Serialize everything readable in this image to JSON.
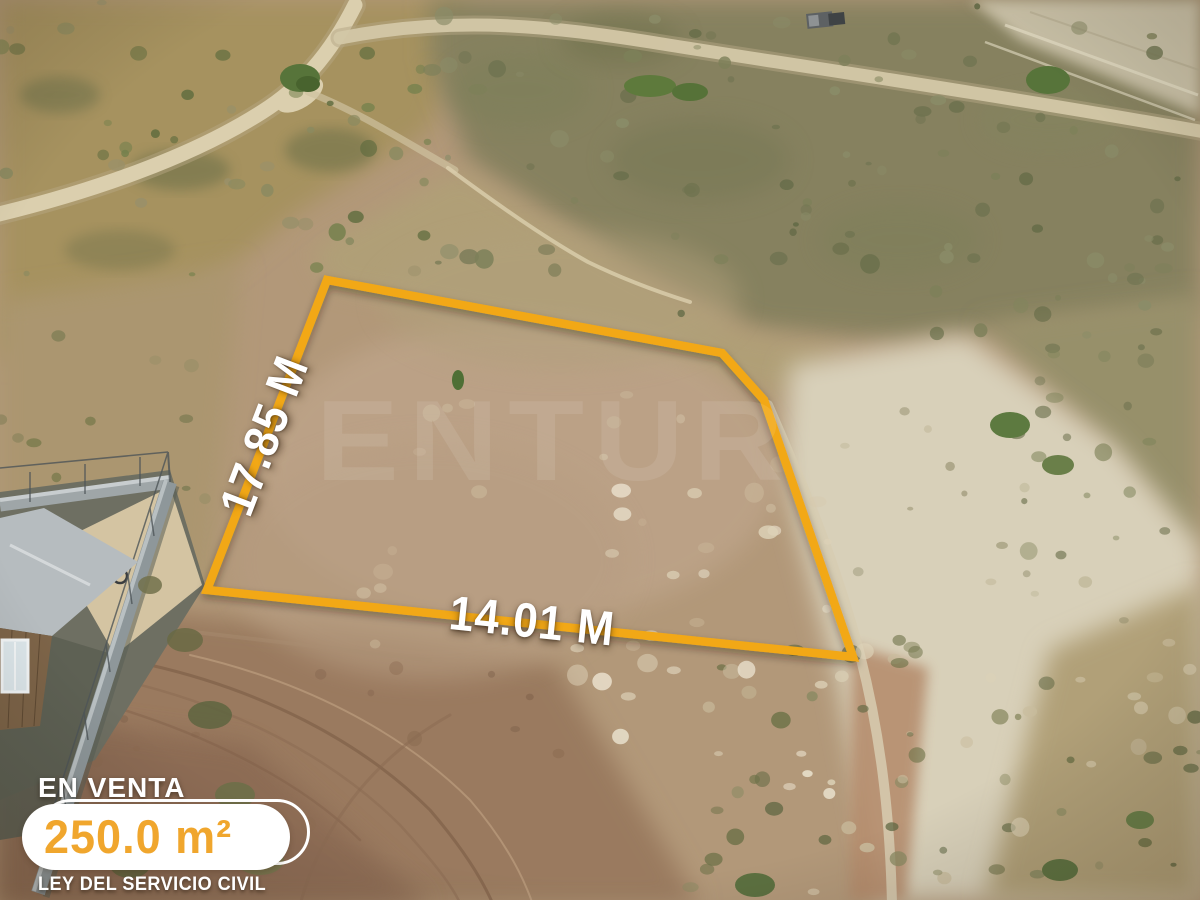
{
  "watermark": {
    "text": "ENTUR"
  },
  "parcel": {
    "outline_points": "327,280 722,353 764,400 853,657 207,590",
    "outline_color": "#F2A814",
    "left_dimension": "17.85 M",
    "bottom_dimension": "14.01 M"
  },
  "listing": {
    "status": "EN VENTA",
    "area": "250.0 m²",
    "law": "LEY DEL SERVICIO CIVIL",
    "accent_color": "#F0A62D"
  }
}
